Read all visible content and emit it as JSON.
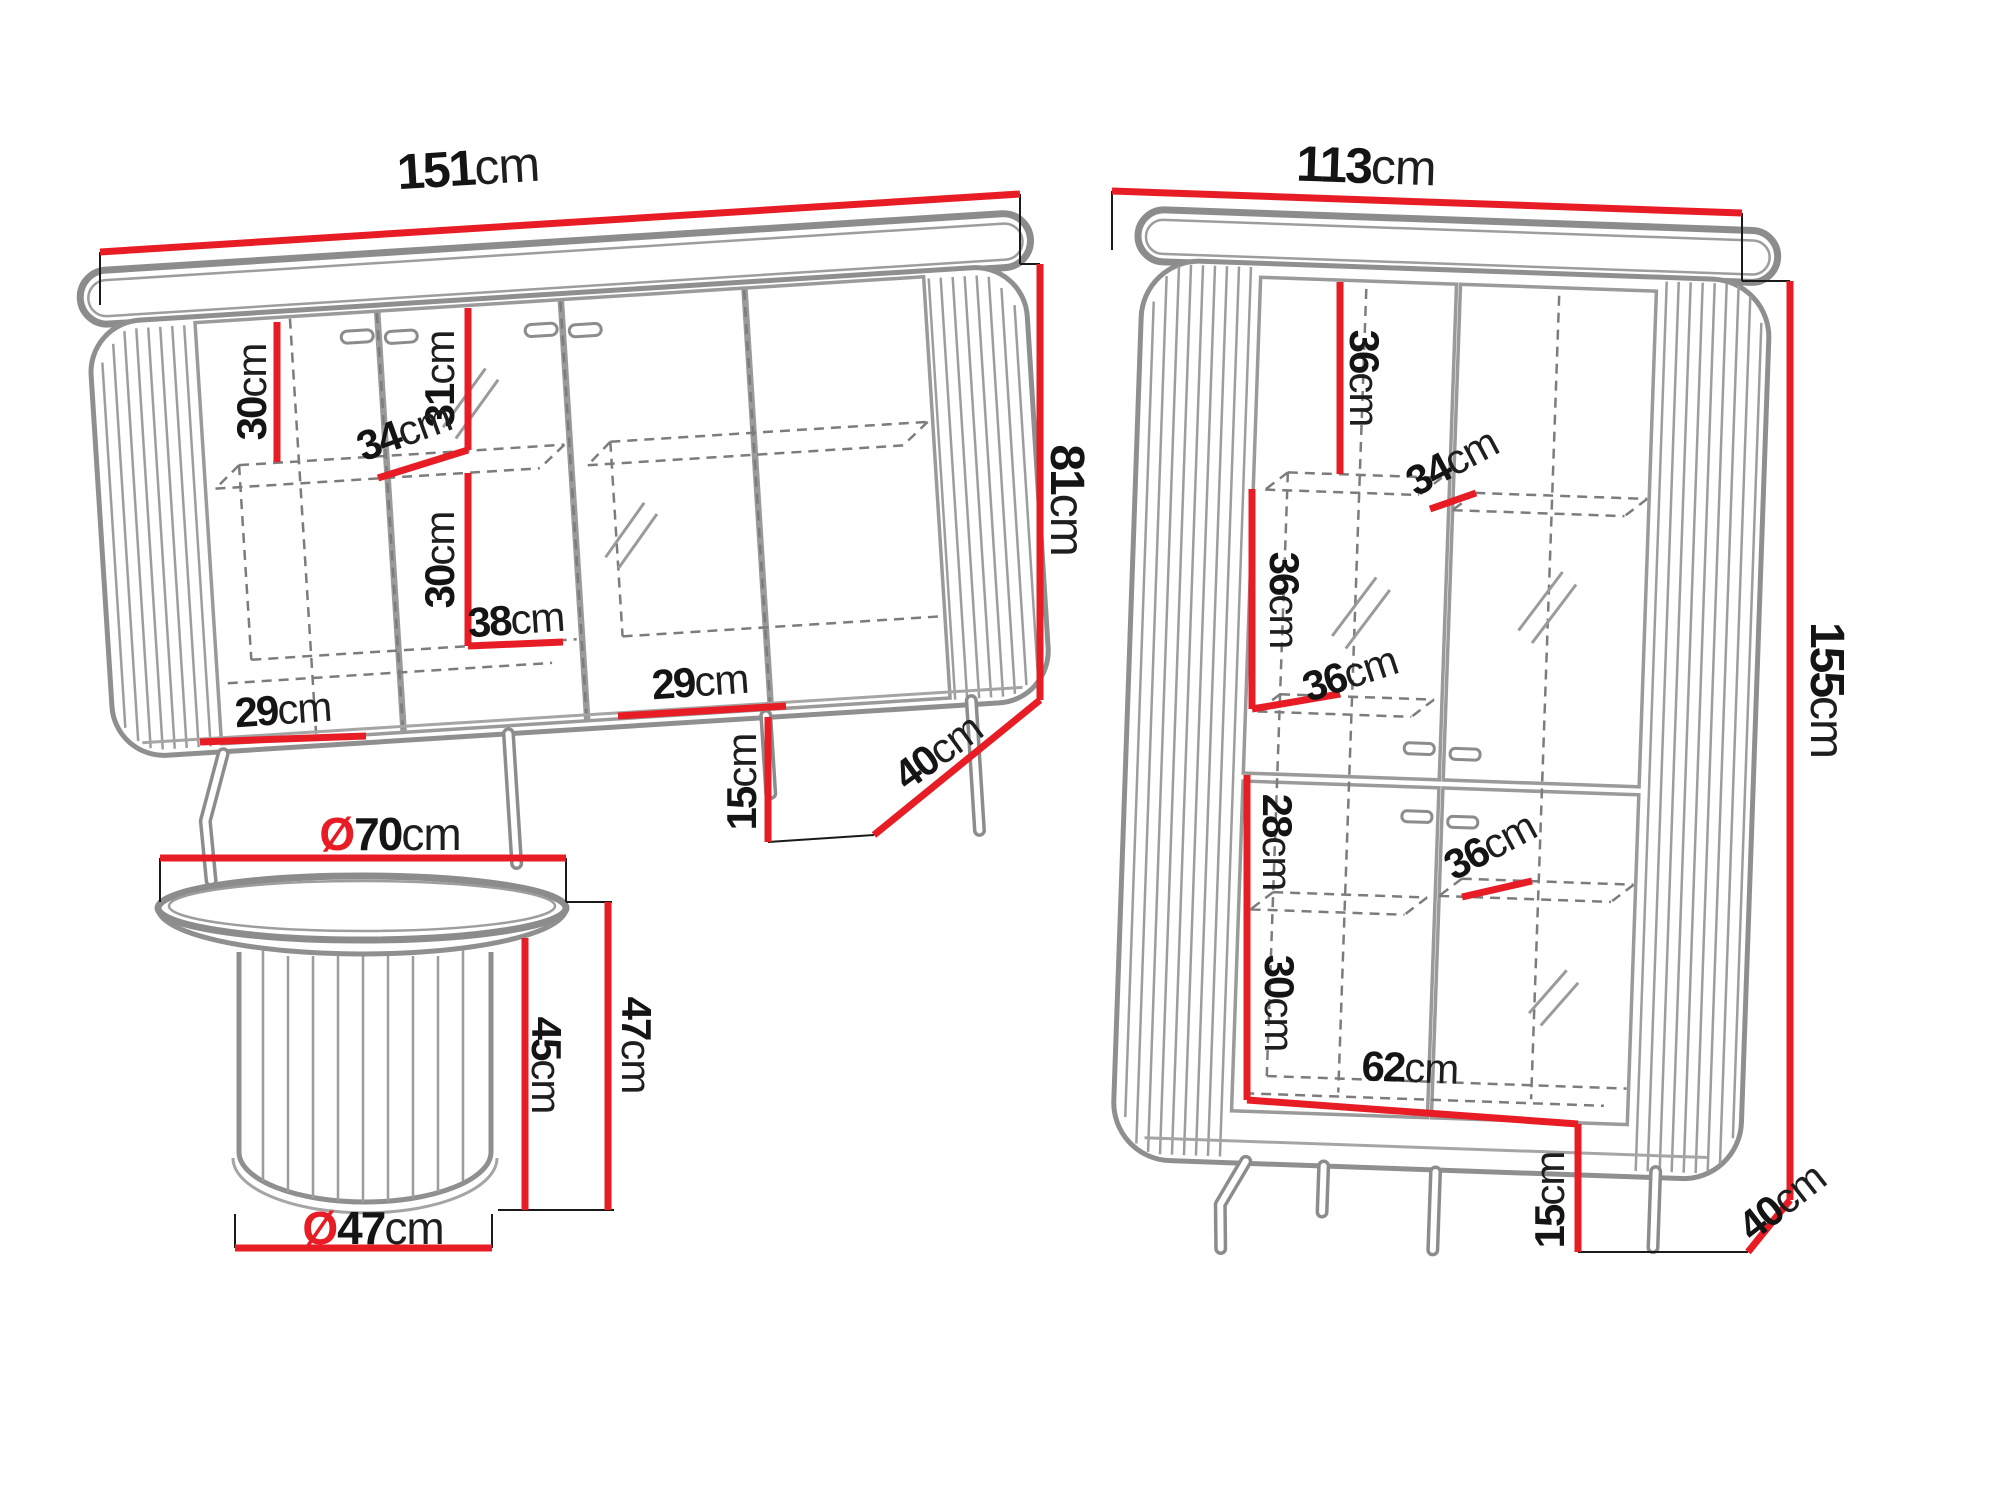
{
  "colors": {
    "dimension_line": "#e81c24",
    "furniture_outline": "#8c8c8c",
    "label_text": "#141414",
    "background": "#ffffff"
  },
  "labels": [
    {
      "piece": "sideboard",
      "dim": "width",
      "value": "151",
      "unit": "cm"
    },
    {
      "piece": "sideboard",
      "dim": "upper-compartment-height",
      "value": "30",
      "unit": "cm"
    },
    {
      "piece": "sideboard",
      "dim": "door-inner-height",
      "value": "31",
      "unit": "cm"
    },
    {
      "piece": "sideboard",
      "dim": "shelf-depth",
      "value": "34",
      "unit": "cm"
    },
    {
      "piece": "sideboard",
      "dim": "lower-compartment-height",
      "value": "30",
      "unit": "cm"
    },
    {
      "piece": "sideboard",
      "dim": "inner-compartment-width",
      "value": "38",
      "unit": "cm"
    },
    {
      "piece": "sideboard",
      "dim": "left-compartment-width",
      "value": "29",
      "unit": "cm"
    },
    {
      "piece": "sideboard",
      "dim": "right-compartment-width",
      "value": "29",
      "unit": "cm"
    },
    {
      "piece": "sideboard",
      "dim": "body-height",
      "value": "81",
      "unit": "cm"
    },
    {
      "piece": "sideboard",
      "dim": "leg-height",
      "value": "15",
      "unit": "cm"
    },
    {
      "piece": "sideboard",
      "dim": "depth",
      "value": "40",
      "unit": "cm"
    },
    {
      "piece": "display-cabinet",
      "dim": "width",
      "value": "113",
      "unit": "cm"
    },
    {
      "piece": "display-cabinet",
      "dim": "top-compartment-height",
      "value": "36",
      "unit": "cm"
    },
    {
      "piece": "display-cabinet",
      "dim": "upper-shelf-depth",
      "value": "34",
      "unit": "cm"
    },
    {
      "piece": "display-cabinet",
      "dim": "middle-compartment-height",
      "value": "36",
      "unit": "cm"
    },
    {
      "piece": "display-cabinet",
      "dim": "middle-shelf-depth",
      "value": "36",
      "unit": "cm"
    },
    {
      "piece": "display-cabinet",
      "dim": "lower-upper-compartment-height",
      "value": "28",
      "unit": "cm"
    },
    {
      "piece": "display-cabinet",
      "dim": "lower-shelf-depth",
      "value": "36",
      "unit": "cm"
    },
    {
      "piece": "display-cabinet",
      "dim": "bottom-compartment-height",
      "value": "30",
      "unit": "cm"
    },
    {
      "piece": "display-cabinet",
      "dim": "inner-width",
      "value": "62",
      "unit": "cm"
    },
    {
      "piece": "display-cabinet",
      "dim": "body-height",
      "value": "155",
      "unit": "cm"
    },
    {
      "piece": "display-cabinet",
      "dim": "leg-height",
      "value": "15",
      "unit": "cm"
    },
    {
      "piece": "display-cabinet",
      "dim": "depth",
      "value": "40",
      "unit": "cm"
    },
    {
      "piece": "coffee-table",
      "dim": "top-diameter",
      "prefix": "Ø",
      "value": "70",
      "unit": "cm"
    },
    {
      "piece": "coffee-table",
      "dim": "base-height",
      "value": "45",
      "unit": "cm"
    },
    {
      "piece": "coffee-table",
      "dim": "total-height",
      "value": "47",
      "unit": "cm"
    },
    {
      "piece": "coffee-table",
      "dim": "base-diameter",
      "prefix": "Ø",
      "value": "47",
      "unit": "cm"
    }
  ]
}
